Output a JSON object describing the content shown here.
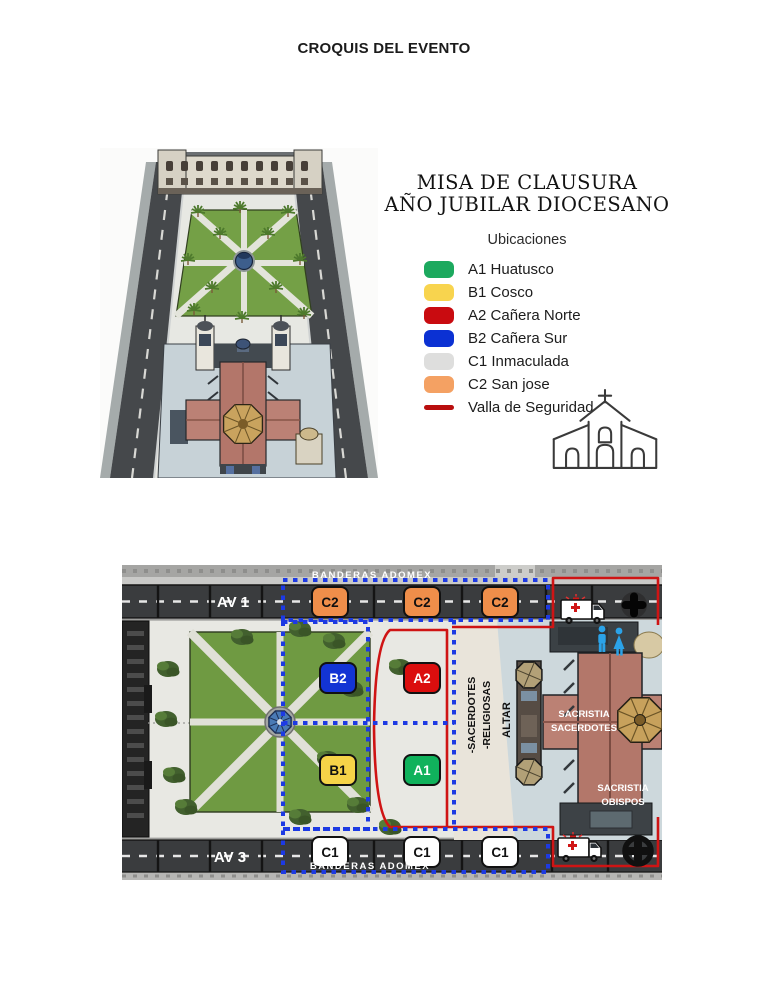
{
  "title": "CROQUIS DEL EVENTO",
  "panel": {
    "heading_line1": "MISA DE CLAUSURA",
    "heading_line2": "AÑO JUBILAR DIOCESANO",
    "legend_title": "Ubicaciones",
    "legend": [
      {
        "label": "A1 Huatusco",
        "color": "#1ca95e"
      },
      {
        "label": "B1 Cosco",
        "color": "#f8d44e"
      },
      {
        "label": "A2 Cañera Norte",
        "color": "#c90b10"
      },
      {
        "label": "B2 Cañera Sur",
        "color": "#0b31d3"
      },
      {
        "label": "C1 Inmaculada",
        "color": "#dededd"
      },
      {
        "label": "C2 San jose",
        "color": "#f4a163"
      },
      {
        "label": "Valla de Seguridad",
        "color": "#b90e0e"
      }
    ]
  },
  "map": {
    "street_top": "AV 1",
    "street_bottom": "AV 3",
    "banner_top": "BANDERAS ADOMEX",
    "banner_bottom": "BANDERAS ADOMEX",
    "row_c2": [
      "C2",
      "C2",
      "C2"
    ],
    "row_c1": [
      "C1",
      "C1",
      "C1"
    ],
    "zone_b2": "B2",
    "zone_b1": "B1",
    "zone_a2": "A2",
    "zone_a1": "A1",
    "label_sacerdotes": "-SACERDOTES",
    "label_religiosas": "-RELIGIOSAS",
    "label_altar": "ALTAR",
    "sacristia_sacerdotes_line1": "SACRISTIA",
    "sacristia_sacerdotes_line2": "SACERDOTES",
    "sacristia_obispos_line1": "SACRISTIA",
    "sacristia_obispos_line2": "OBISPOS",
    "colors": {
      "zone_c2": "#ef8e4a",
      "zone_c1": "#ffffff",
      "zone_b2": "#1334d4",
      "zone_b1": "#f6d348",
      "zone_a2": "#db0e0e",
      "zone_a1": "#10b25c",
      "security_fence": "#cf1414",
      "dotted_line": "#1d3ae3"
    }
  }
}
